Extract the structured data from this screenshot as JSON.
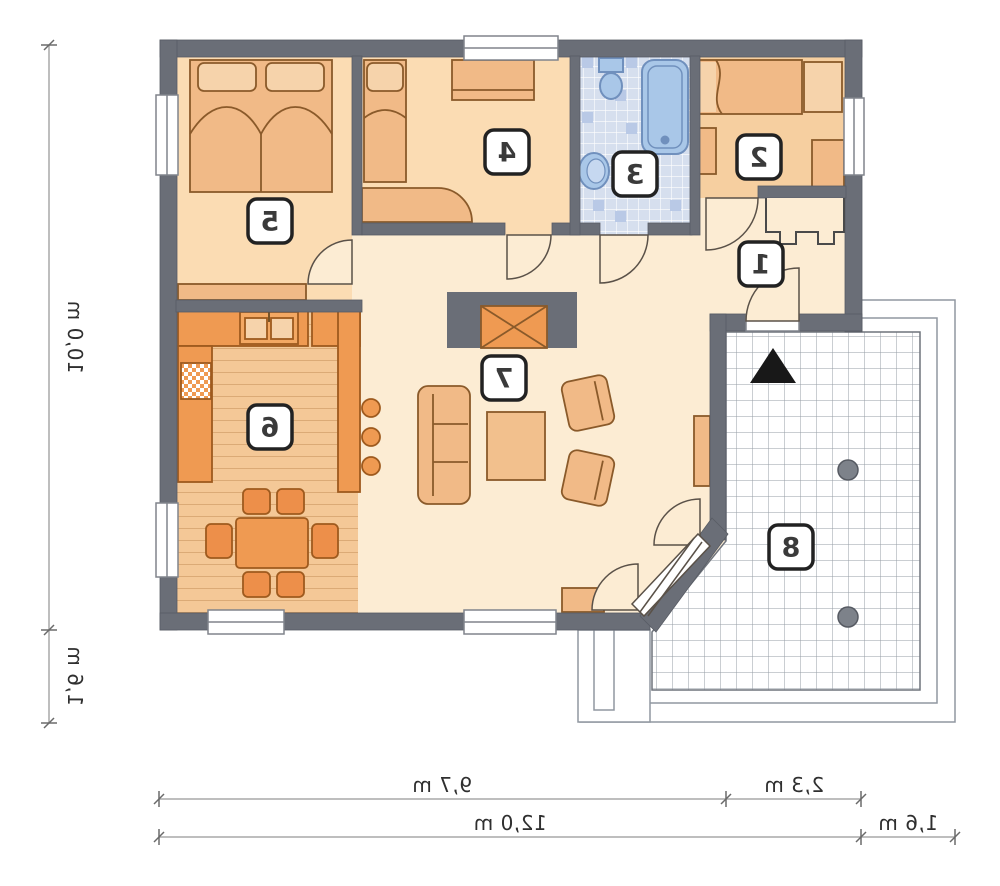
{
  "plan": {
    "kind": "house floor plan (mirrored print)",
    "rooms": [
      {
        "number": "1"
      },
      {
        "number": "2"
      },
      {
        "number": "3"
      },
      {
        "number": "4"
      },
      {
        "number": "5"
      },
      {
        "number": "6"
      },
      {
        "number": "7"
      },
      {
        "number": "8"
      }
    ],
    "dimensions": {
      "left_total": "10,0 m",
      "left_lower": "1,6 m",
      "bottom_main": "9,7 m",
      "bottom_terrace": "2,3 m",
      "bottom_total": "12,0 m",
      "bottom_overhang": "1,6 m"
    },
    "colors": {
      "wall": "#6a6e77",
      "floor_hall": "#fcecd3",
      "floor_bedroom": "#fbdcb3",
      "floor_bedroom_right": "#f6cfa0",
      "floor_wood": "#f4c897",
      "furniture_orange": "#ef9a52",
      "furniture_peach": "#f1ba87",
      "bath_fixture": "#a9c7e8",
      "bath_floor": "#d6dfee",
      "terrace_line": "#969ca6",
      "dimension_line": "#a9a9a9",
      "label_text": "#3a3a3a",
      "entrance_arrow": "#181818"
    }
  }
}
